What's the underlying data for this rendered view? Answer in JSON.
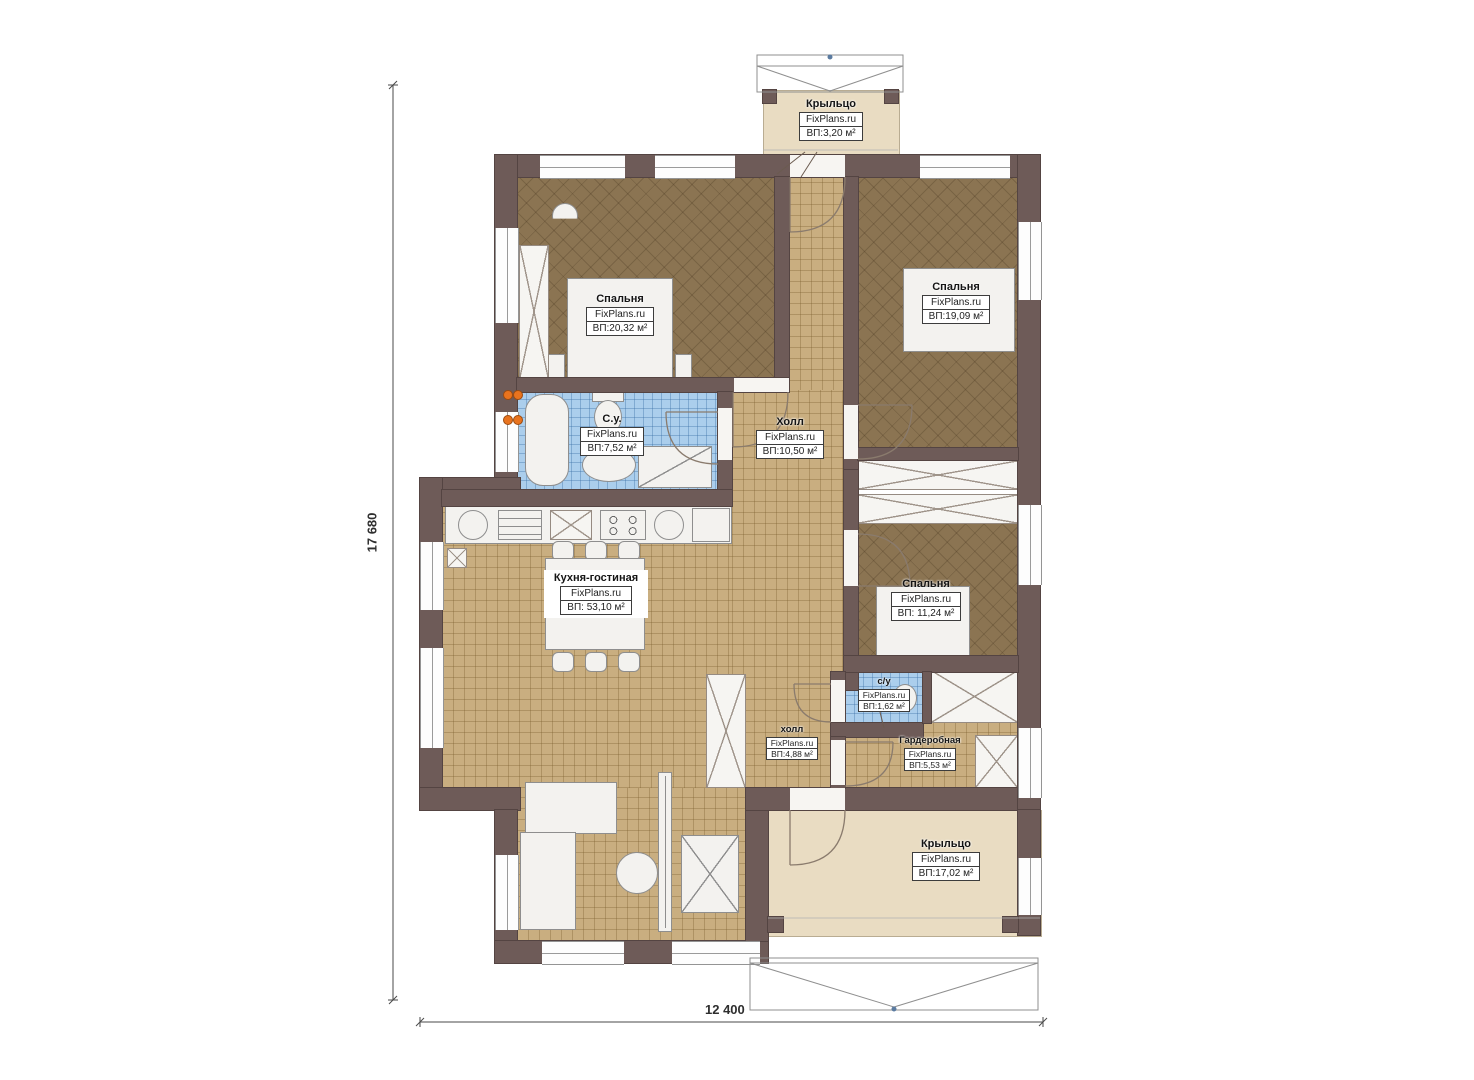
{
  "brand": "FixPlans.ru",
  "plan_title": "Floor plan of a single-storey house",
  "dimensions": {
    "height_label": "17 680",
    "width_label": "12 400"
  },
  "rooms": {
    "porch_top": {
      "name": "Крыльцо",
      "area": "ВП:3,20 м²"
    },
    "bedroom1": {
      "name": "Спальня",
      "area": "ВП:20,32 м²"
    },
    "bedroom2": {
      "name": "Спальня",
      "area": "ВП:19,09 м²"
    },
    "bathroom": {
      "name": "С.у.",
      "area": "ВП:7,52 м²"
    },
    "hall": {
      "name": "Холл",
      "area": "ВП:10,50 м²"
    },
    "kitchen": {
      "name": "Кухня-гостиная",
      "area": "ВП: 53,10 м²"
    },
    "bedroom3": {
      "name": "Спальня",
      "area": "ВП: 11,24 м²"
    },
    "wc": {
      "name": "с/у",
      "area": "ВП:1,62 м²"
    },
    "hall2": {
      "name": "холл",
      "area": "ВП:4,88 м²"
    },
    "wardrobe": {
      "name": "Гардеробная",
      "area": "ВП:5,53 м²"
    },
    "porch_bottom": {
      "name": "Крыльцо",
      "area": "ВП:17,02 м²"
    }
  },
  "colors": {
    "wall": "#6e5b58",
    "bedroom_floor": "#8b7452",
    "tile_floor": "#c9ae80",
    "bath_floor": "#abceec",
    "porch_floor": "#e9dcc2",
    "radiator_dots": "#e8731e"
  }
}
